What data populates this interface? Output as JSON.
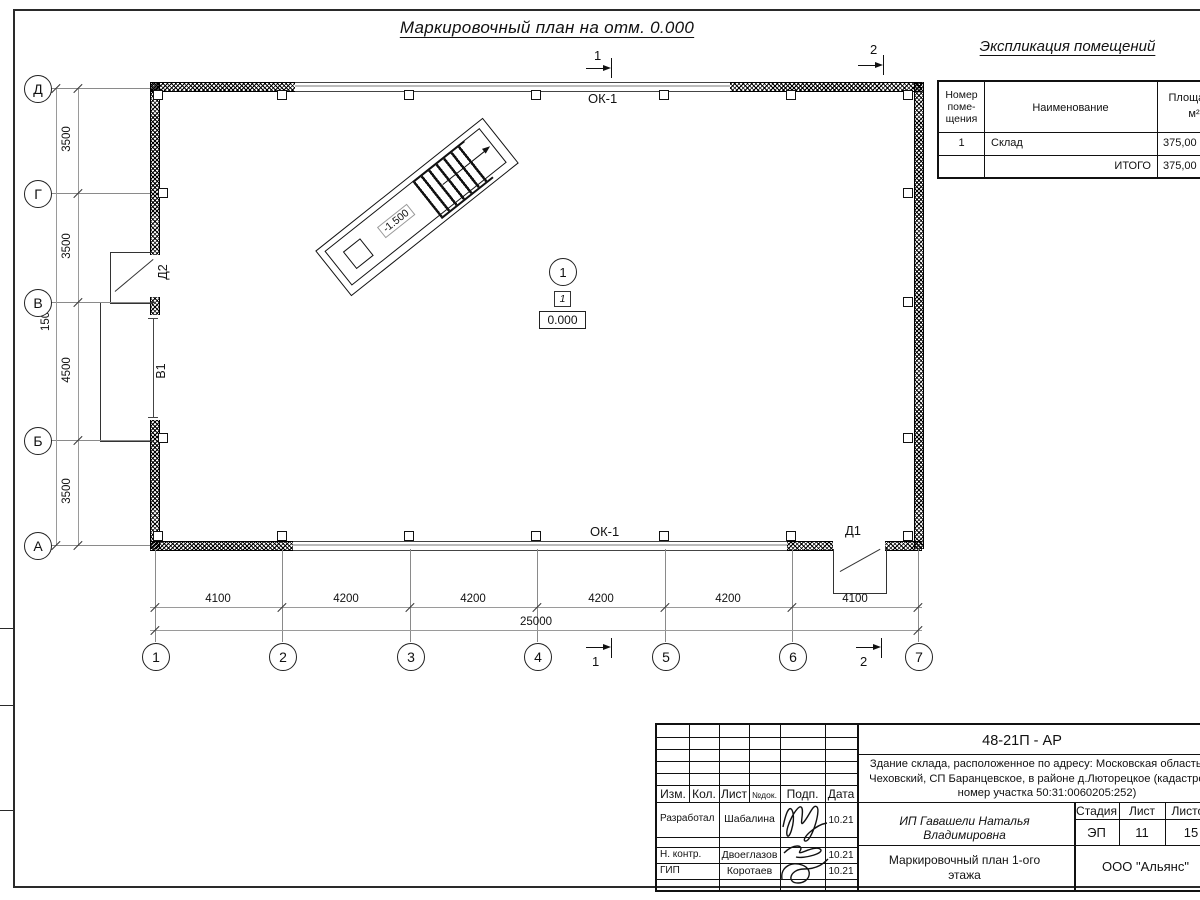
{
  "sheet": {
    "title": "Маркировочный план на отм. 0.000"
  },
  "explication": {
    "title": "Экспликация  помещений",
    "header": {
      "col1_l1": "Номер",
      "col1_l2": "поме-",
      "col1_l3": "щения",
      "col2": "Наименование",
      "col3_l1": "Площадь,",
      "col3_l2": "м²"
    },
    "rows": [
      {
        "num": "1",
        "name": "Склад",
        "area": "375,00"
      },
      {
        "num": "",
        "name": "ИТОГО",
        "area": "375,00"
      }
    ]
  },
  "plan": {
    "window_label": "ОК-1",
    "door1": "Д1",
    "door2": "Д2",
    "gate": "В1",
    "ramp_elevation": "-1.500",
    "room_number": "1",
    "room_marker": "1",
    "floor_elevation": "0.000",
    "section1": "1",
    "section2": "2"
  },
  "axes": {
    "horizontal": [
      "1",
      "2",
      "3",
      "4",
      "5",
      "6",
      "7"
    ],
    "vertical": [
      "Д",
      "Г",
      "В",
      "Б",
      "А"
    ],
    "dims_bottom": [
      "4100",
      "4200",
      "4200",
      "4200",
      "4200",
      "4100"
    ],
    "total_bottom": "25000",
    "dims_left": [
      "3500",
      "3500",
      "4500",
      "3500"
    ],
    "total_left": "15000"
  },
  "titleblock": {
    "doc_number": "48-21П - АР",
    "desc_line1": "Здание склада, расположенное по адресу: Московская область, р-н",
    "desc_line2": "Чеховский, СП Баранцевское, в районе д.Люторецкое  (кадастровый",
    "desc_line3": "номер участка 50:31:0060205:252)",
    "cols": {
      "izm": "Изм.",
      "kol": "Кол.",
      "list": "Лист",
      "ndok": "№док.",
      "podp": "Подп.",
      "data": "Дата"
    },
    "row1_role": "Разработал",
    "row1_name": "Шабалина",
    "row1_date": "10.21",
    "row2_role": "Н. контр.",
    "row2_name": "Двоеглазов",
    "row2_date": "10.21",
    "row3_role": "ГИП",
    "row3_name": "Коротаев",
    "row3_date": "10.21",
    "client": "ИП Гавашели Наталья Владимировна",
    "stage_label": "Стадия",
    "sheet_label": "Лист",
    "sheets_label": "Листов",
    "stage": "ЭП",
    "sheet_num": "11",
    "sheets_total": "15",
    "doc_title_l1": "Маркировочный план 1-ого",
    "doc_title_l2": "этажа",
    "company": "ООО \"Альянс\""
  }
}
